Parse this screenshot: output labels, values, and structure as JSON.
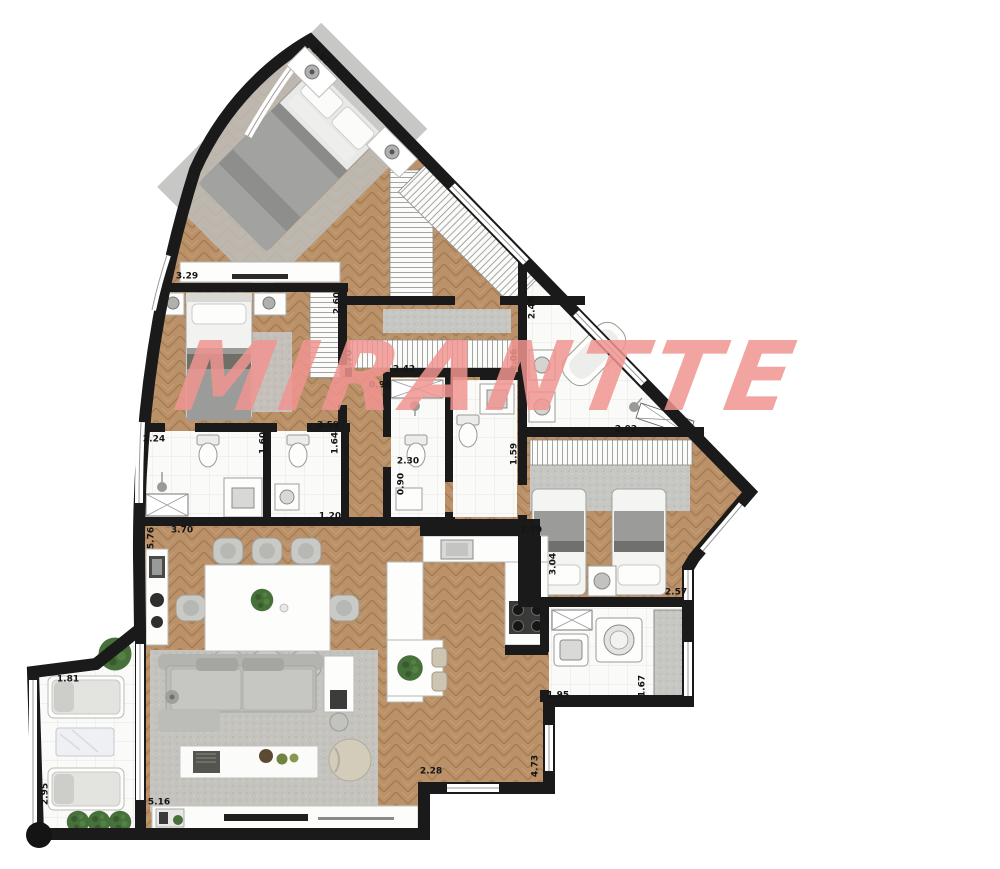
{
  "watermark": {
    "text": "MIRANTTE",
    "color": "rgba(240,148,145,0.85)"
  },
  "colors": {
    "wood": "#b98f66",
    "wall": "#1a1a1a",
    "tile": "#fafaf8",
    "rug": "#c6c6c3",
    "plant": "#47703a",
    "label": "#141414",
    "watermark": "rgba(240,148,145,0.85)"
  },
  "dimensions": [
    {
      "label": "2.82",
      "x": 320,
      "y": 57,
      "rot": 45
    },
    {
      "label": "3.29",
      "x": 187,
      "y": 277,
      "rot": 0
    },
    {
      "label": "2.60",
      "x": 338,
      "y": 303,
      "rot": -90
    },
    {
      "label": "1.70",
      "x": 350,
      "y": 361,
      "rot": -90
    },
    {
      "label": "2.42",
      "x": 404,
      "y": 370,
      "rot": 0
    },
    {
      "label": "0.90",
      "x": 380,
      "y": 386,
      "rot": 0
    },
    {
      "label": "2.48",
      "x": 533,
      "y": 308,
      "rot": -90
    },
    {
      "label": "2.06",
      "x": 515,
      "y": 360,
      "rot": -90
    },
    {
      "label": "2.02",
      "x": 626,
      "y": 430,
      "rot": 0
    },
    {
      "label": "2.24",
      "x": 154,
      "y": 440,
      "rot": 0
    },
    {
      "label": "1.60",
      "x": 264,
      "y": 443,
      "rot": -90
    },
    {
      "label": "1.64",
      "x": 336,
      "y": 443,
      "rot": -90
    },
    {
      "label": "3.59",
      "x": 328,
      "y": 426,
      "rot": 0
    },
    {
      "label": "2.30",
      "x": 408,
      "y": 462,
      "rot": 0
    },
    {
      "label": "0.90",
      "x": 402,
      "y": 484,
      "rot": -90
    },
    {
      "label": "1.20",
      "x": 330,
      "y": 517,
      "rot": 0
    },
    {
      "label": "1.59",
      "x": 515,
      "y": 454,
      "rot": -90
    },
    {
      "label": "3.70",
      "x": 182,
      "y": 531,
      "rot": 0
    },
    {
      "label": "5.76",
      "x": 152,
      "y": 538,
      "rot": -90
    },
    {
      "label": "2.79",
      "x": 531,
      "y": 531,
      "rot": 0
    },
    {
      "label": "3.04",
      "x": 554,
      "y": 564,
      "rot": -90
    },
    {
      "label": "2.57",
      "x": 676,
      "y": 593,
      "rot": 0
    },
    {
      "label": "1.95",
      "x": 558,
      "y": 696,
      "rot": 0
    },
    {
      "label": "1.67",
      "x": 643,
      "y": 686,
      "rot": -90
    },
    {
      "label": "1.81",
      "x": 68,
      "y": 680,
      "rot": 0
    },
    {
      "label": "2.95",
      "x": 46,
      "y": 794,
      "rot": -90
    },
    {
      "label": "5.16",
      "x": 159,
      "y": 803,
      "rot": 0
    },
    {
      "label": "2.28",
      "x": 431,
      "y": 772,
      "rot": 0
    },
    {
      "label": "4.73",
      "x": 536,
      "y": 766,
      "rot": -90
    }
  ]
}
